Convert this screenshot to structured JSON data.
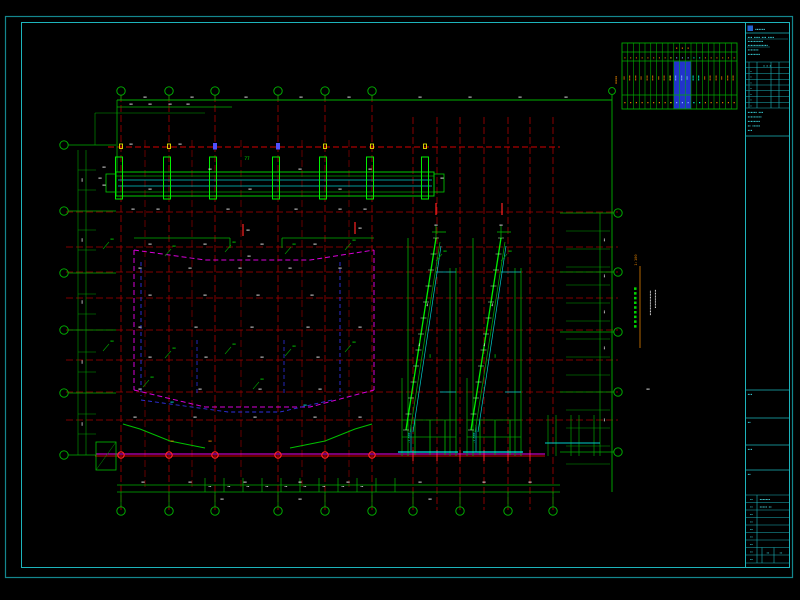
{
  "frame": {
    "outer_color": "#14868e",
    "inner_color": "#1db4bc"
  },
  "drawing": {
    "smudge": "▪▪",
    "title_vertical": "▪▪▪▪▪▪▪▪▪",
    "title_scale": "1:100",
    "note_line1": "▪▪▪▪▪▪▪▪▪▪▪▪▪▪▪▪",
    "note_line2": "▪▪▪▪▪▪▪▪▪▪▪▪",
    "elevation_label": "-1.500",
    "beam_mark": "77"
  },
  "summary_table": {
    "left_label": "▪▪▪▪",
    "rev_header": "▪  ▪  ▪",
    "header_marks": [
      "",
      "",
      "",
      "",
      "",
      "",
      "",
      "",
      "",
      "▪",
      "▪",
      "▪",
      "",
      "",
      "",
      "",
      "",
      "",
      "",
      ""
    ],
    "row_small": [
      "▪",
      "▪",
      "▪",
      "▪",
      "▪",
      "▪",
      "▪",
      "▪",
      "▪",
      "▪",
      "▪",
      "▪",
      "▪",
      "▪",
      "▪",
      "▪",
      "▪",
      "▪",
      "▪",
      "▪"
    ],
    "row_tall": [
      "▪▪",
      "▪▪▪",
      "▪▪▪",
      "▪▪",
      "▪▪▪",
      "▪▪▪",
      "▪▪",
      "▪▪▪",
      "▪▪▪",
      "▪▪▪",
      "▪▪▪",
      "▪▪",
      "▪▪▪",
      "▪▪▪",
      "▪▪",
      "▪▪▪",
      "▪▪▪",
      "▪▪",
      "▪▪▪",
      "▪▪▪"
    ],
    "row_bottom": [
      "▪",
      "▪",
      "▪",
      "▪",
      "▪",
      "▪",
      "▪",
      "▪",
      "▪",
      "▪",
      "▪",
      "▪",
      "▪",
      "▪",
      "▪",
      "▪",
      "▪",
      "▪",
      "▪",
      "▪"
    ],
    "highlights": {
      "yellow_col": 8,
      "blue_cols": [
        9,
        10,
        11
      ],
      "cyan_cols": [
        12,
        13
      ]
    }
  },
  "title_block": {
    "logo_text": "▪▪▪▪▪▪",
    "header_lines": [
      "▪▪▪ ▪▪▪▪ ▪▪▪ ▪▪▪▪",
      "▪▪▪▪▪▪▪▪▪▪",
      "▪▪▪▪▪▪▪▪▪▪▪▪▪",
      "▪▪▪▪▪▪▪",
      "▪▪▪▪▪▪▪▪"
    ],
    "rev_header": "▪  ▪  ▪",
    "left_col_mark": "▪",
    "info_lines": [
      "▪▪▪▪▪▪ ▪▪▪",
      "▪▪▪▪▪▪▪▪▪",
      "▪▪▪▪▪▪▪▪",
      "▪▪ ▪▪▪▪▪",
      "▪▪▪"
    ],
    "section_labels": [
      "▪▪▪",
      "▪▪",
      "▪▪▪",
      "▪▪"
    ],
    "field_labels": [
      "▪▪",
      "▪▪",
      "▪▪",
      "▪▪",
      "▪▪",
      "▪▪",
      "▪▪",
      "▪▪",
      "▪▪"
    ],
    "field_values": [
      "▪▪▪▪▪▪▪",
      "▪▪▪▪▪ ▪▪"
    ],
    "corner_marks": [
      "▪▪",
      "▪▪"
    ]
  },
  "ann": [
    [
      145,
      98
    ],
    [
      192,
      98
    ],
    [
      246,
      98
    ],
    [
      301,
      98
    ],
    [
      349,
      98
    ],
    [
      420,
      98
    ],
    [
      470,
      98
    ],
    [
      520,
      98
    ],
    [
      566,
      98
    ],
    [
      131,
      105
    ],
    [
      150,
      105
    ],
    [
      170,
      105
    ],
    [
      188,
      105
    ],
    [
      104,
      168
    ],
    [
      104,
      186
    ],
    [
      210,
      170
    ],
    [
      300,
      170
    ],
    [
      370,
      170
    ],
    [
      150,
      190
    ],
    [
      250,
      190
    ],
    [
      340,
      190
    ],
    [
      100,
      179
    ],
    [
      442,
      179
    ],
    [
      131,
      145
    ],
    [
      180,
      145
    ],
    [
      133,
      210
    ],
    [
      158,
      210
    ],
    [
      228,
      210
    ],
    [
      296,
      210
    ],
    [
      340,
      210
    ],
    [
      365,
      210
    ],
    [
      150,
      245
    ],
    [
      205,
      245
    ],
    [
      262,
      245
    ],
    [
      315,
      245
    ],
    [
      249,
      257
    ],
    [
      140,
      269
    ],
    [
      190,
      269
    ],
    [
      240,
      269
    ],
    [
      290,
      269
    ],
    [
      340,
      269
    ],
    [
      150,
      296
    ],
    [
      205,
      296
    ],
    [
      258,
      296
    ],
    [
      312,
      296
    ],
    [
      140,
      328
    ],
    [
      196,
      328
    ],
    [
      252,
      328
    ],
    [
      308,
      328
    ],
    [
      360,
      328
    ],
    [
      150,
      358
    ],
    [
      206,
      358
    ],
    [
      262,
      358
    ],
    [
      318,
      358
    ],
    [
      140,
      390
    ],
    [
      200,
      390
    ],
    [
      260,
      390
    ],
    [
      320,
      390
    ],
    [
      135,
      418
    ],
    [
      195,
      418
    ],
    [
      255,
      418
    ],
    [
      315,
      418
    ],
    [
      360,
      418
    ],
    [
      172,
      403,
      "c"
    ],
    [
      305,
      406,
      "c"
    ],
    [
      172,
      442,
      "o"
    ],
    [
      210,
      442,
      "o"
    ],
    [
      143,
      483
    ],
    [
      190,
      483
    ],
    [
      245,
      483
    ],
    [
      300,
      483
    ],
    [
      348,
      483
    ],
    [
      420,
      483
    ],
    [
      484,
      483
    ],
    [
      530,
      483
    ],
    [
      222,
      500
    ],
    [
      300,
      500
    ],
    [
      430,
      500
    ],
    [
      210,
      487,
      "w",
      2.4
    ],
    [
      229,
      487,
      "w",
      2.4
    ],
    [
      248,
      487,
      "w",
      2.4
    ],
    [
      267,
      487,
      "w",
      2.4
    ],
    [
      286,
      487,
      "w",
      2.4
    ],
    [
      305,
      487,
      "w",
      2.4
    ],
    [
      324,
      487,
      "w",
      2.4
    ],
    [
      343,
      487,
      "w",
      2.4
    ],
    [
      362,
      487,
      "w",
      2.4
    ],
    [
      83,
      180,
      "w",
      3,
      -90
    ],
    [
      83,
      240,
      "w",
      3,
      -90
    ],
    [
      83,
      302,
      "w",
      3,
      -90
    ],
    [
      83,
      362,
      "w",
      3,
      -90
    ],
    [
      83,
      424,
      "w",
      3,
      -90
    ],
    [
      605,
      240,
      "w",
      2.6,
      -90
    ],
    [
      605,
      276,
      "w",
      2.6,
      -90
    ],
    [
      605,
      312,
      "w",
      2.6,
      -90
    ],
    [
      605,
      348,
      "w",
      2.6,
      -90
    ],
    [
      605,
      420,
      "w",
      2.6,
      -90
    ],
    [
      436,
      226
    ],
    [
      501,
      226
    ],
    [
      445,
      252,
      "g"
    ],
    [
      510,
      252,
      "g"
    ],
    [
      420,
      345,
      "w",
      2.6,
      -80
    ],
    [
      428,
      305,
      "w",
      2.6,
      -80
    ],
    [
      485,
      345,
      "w",
      2.6,
      -80
    ],
    [
      493,
      305,
      "w",
      2.6,
      -80
    ],
    [
      431,
      356,
      "g",
      3,
      -90
    ],
    [
      496,
      356,
      "g",
      3,
      -90
    ],
    [
      248,
      231
    ],
    [
      360,
      229
    ],
    [
      648,
      390
    ],
    [
      112,
      240,
      "g"
    ],
    [
      174,
      247,
      "g"
    ],
    [
      234,
      243,
      "g"
    ],
    [
      294,
      245,
      "g"
    ],
    [
      354,
      241,
      "g"
    ],
    [
      112,
      342,
      "g"
    ],
    [
      174,
      349,
      "g"
    ],
    [
      234,
      345,
      "g"
    ],
    [
      294,
      347,
      "g"
    ],
    [
      354,
      343,
      "g"
    ],
    [
      152,
      378,
      "g"
    ],
    [
      262,
      380,
      "g"
    ]
  ]
}
